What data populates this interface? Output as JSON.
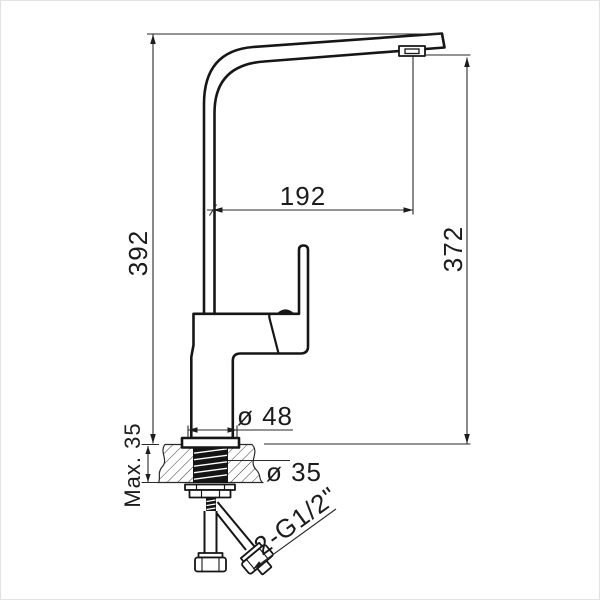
{
  "drawing": {
    "kind": "faucet-installation-dimension-drawing",
    "background_color": "#ffffff",
    "line_color": "#161616"
  },
  "labels": {
    "total_height": "392",
    "spout_height": "372",
    "spout_reach": "192",
    "base_diameter": "ø 48",
    "shank_diameter": "ø 35",
    "max_deck_thickness": "Max. 35",
    "connection": "2-G1/2\""
  },
  "values": {
    "total_height": 392,
    "spout_height": 372,
    "spout_reach": 192,
    "base_diameter": 48,
    "shank_diameter": 35,
    "max_deck_thickness": 35,
    "connection_thread": "G1/2",
    "connection_count": 2
  }
}
